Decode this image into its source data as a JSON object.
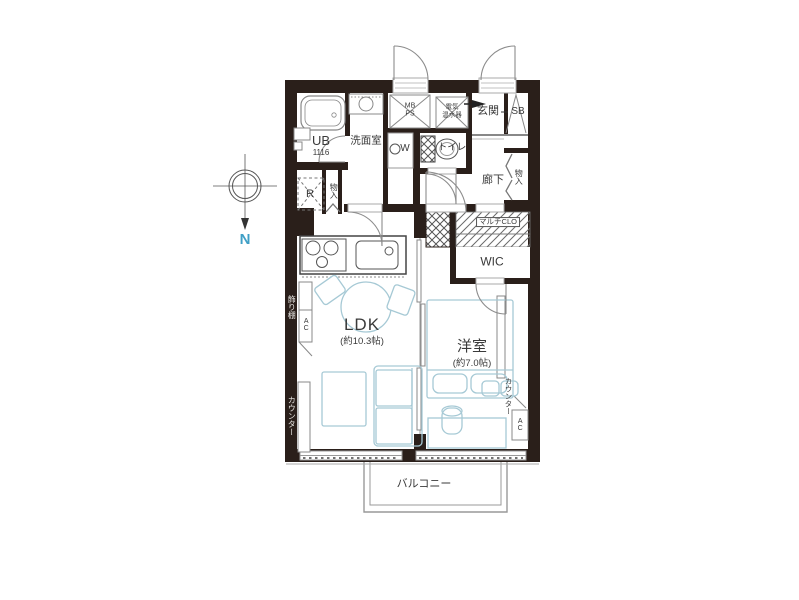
{
  "colors": {
    "wall": "#2a1f1a",
    "line": "#8c8c8c",
    "furn": "#a6c9d5",
    "ink": "#3a3a3a",
    "wallink": "#e8e6e2",
    "north": "#3f9fc6"
  },
  "compass": {
    "north_label": "N"
  },
  "rooms": {
    "ub": {
      "label": "UB",
      "size": "1116"
    },
    "washroom": {
      "label": "洗面室"
    },
    "washer": {
      "label": "W"
    },
    "mb_ps": {
      "line1": "MB",
      "line2": "PS"
    },
    "water_heater": {
      "line1": "電気",
      "line2": "温水器"
    },
    "entrance": {
      "label": "玄関"
    },
    "shoe_box": {
      "label": "SB"
    },
    "toilet": {
      "label": "トイレ"
    },
    "hallway": {
      "label": "廊下"
    },
    "storage_right": {
      "label": "物入"
    },
    "storage_left": {
      "label": "物入"
    },
    "refrigerator": {
      "label": "R"
    },
    "multi_closet": {
      "label": "マルチCLO"
    },
    "wic": {
      "label": "WIC"
    },
    "ldk": {
      "label": "LDK",
      "area": "(約10.3帖)"
    },
    "bedroom": {
      "label": "洋室",
      "area": "(約7.0帖)"
    },
    "balcony": {
      "label": "バルコニー"
    }
  },
  "fixtures": {
    "shelf": {
      "label": "飾り棚"
    },
    "ac_left": {
      "label": "AC"
    },
    "ac_right": {
      "label": "AC"
    },
    "counter_left": {
      "label": "カウンター"
    },
    "counter_right": {
      "label": "カウンター"
    }
  }
}
